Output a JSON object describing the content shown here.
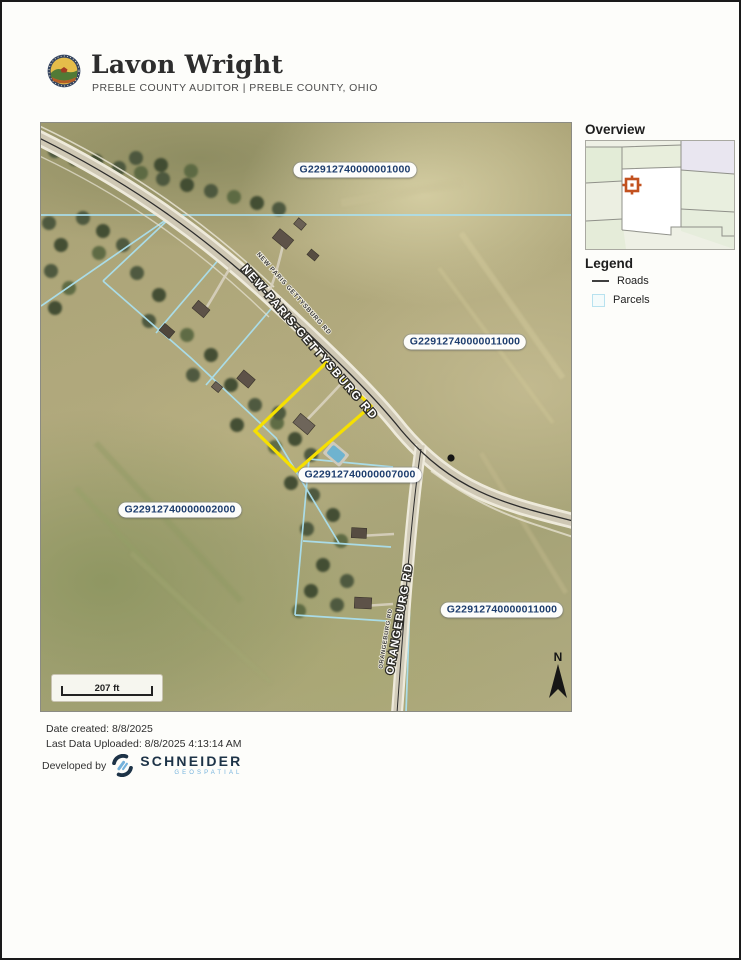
{
  "header": {
    "name": "Lavon Wright",
    "subtitle": "PREBLE COUNTY AUDITOR  |  PREBLE COUNTY, OHIO"
  },
  "map": {
    "parcel_labels": [
      {
        "text": "G22912740000001000"
      },
      {
        "text": "G22912740000011000"
      },
      {
        "text": "G22912740000007000"
      },
      {
        "text": "G22912740000002000"
      },
      {
        "text": "G22912740000011000"
      }
    ],
    "road_labels": {
      "main_road": "NEW-PARIS-GETTYSBURG RD",
      "main_road_small": "NEW PARIS GETTYSBURG RD",
      "cross_road": "ORANGEBURG RD",
      "cross_road_small": "ORANGEBURG RD"
    },
    "scale_bar": {
      "label": "207 ft"
    },
    "north_arrow": {
      "label": "N"
    }
  },
  "sidebar": {
    "overview": {
      "title": "Overview"
    },
    "legend": {
      "title": "Legend",
      "items": [
        {
          "label": "Roads",
          "swatch": "road-line"
        },
        {
          "label": "Parcels",
          "swatch": "parcel-square"
        }
      ]
    }
  },
  "footer": {
    "date_created": "Date created: 8/8/2025",
    "last_uploaded": "Last Data Uploaded: 8/8/2025 4:13:14 AM",
    "developed_by": "Developed by",
    "vendor": {
      "name": "SCHNEIDER",
      "tagline": "GEOSPATIAL"
    }
  },
  "colors": {
    "highlight_parcel": "#f6e000",
    "parcel_line": "#aadfee",
    "parcel_label_text": "#1d3d6e",
    "marker_orange": "#c2511f",
    "schneider_navy": "#1d3347",
    "schneider_blue": "#74b2dc"
  }
}
